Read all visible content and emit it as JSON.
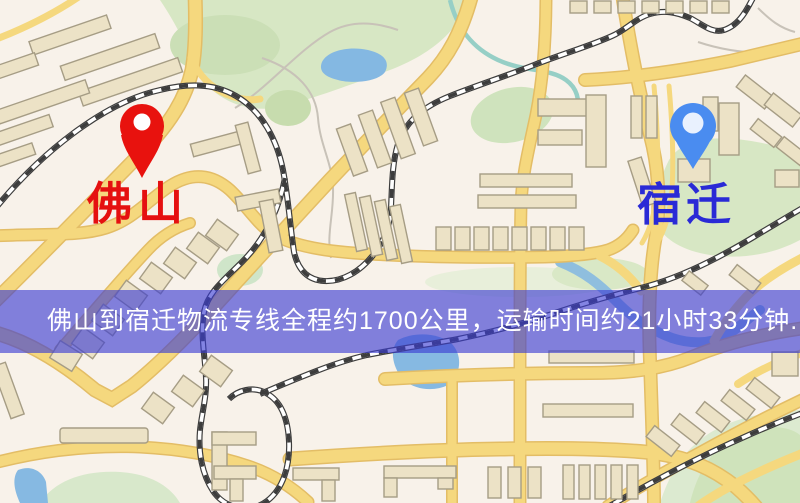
{
  "page": {
    "width": 800,
    "height": 503
  },
  "map": {
    "type": "road-map",
    "origin": {
      "name": "佛山",
      "marker": "red-map-pin",
      "marker_color": "#e8120e",
      "label_color": "#e51010"
    },
    "destination": {
      "name": "宿迁",
      "marker": "blue-map-pin",
      "marker_color": "#4a8cf0",
      "label_color": "#2a2ad6"
    },
    "banner": {
      "text": "佛山到宿迁物流专线全程约1700公里，运输时间约21小时33分钟.",
      "background_color": "rgba(58,60,210,0.63)",
      "text_color": "#ffffff"
    },
    "route_facts": {
      "from": "佛山",
      "to": "宿迁",
      "distance": "约1700公里",
      "duration": "约21小时33分钟"
    },
    "palette": {
      "background": "#f8f2ea",
      "road": "#f5d87e",
      "road_casing": "#e3bd66",
      "park": "#d7e7c4",
      "water": "#84b8e2",
      "railway": "#3d3d3d",
      "building": "#ece2c6",
      "building_outline": "#a69d85"
    }
  }
}
